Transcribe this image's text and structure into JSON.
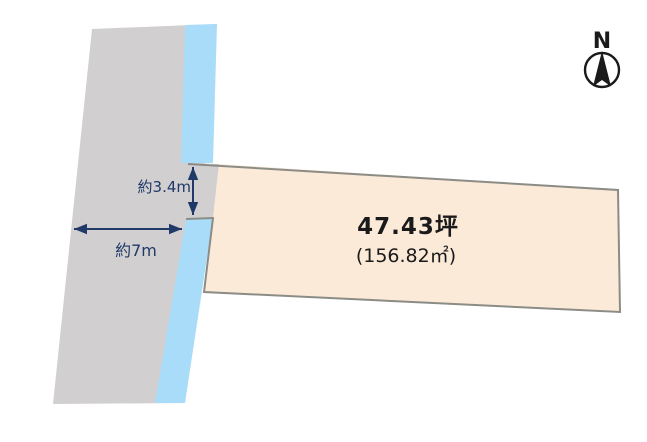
{
  "diagram": {
    "compass_label": "N",
    "parcel": {
      "area_tsubo": "47.43坪",
      "area_sqm_paren": "(156.82㎡)"
    },
    "dimensions": {
      "frontage_width": "約3.4m",
      "road_width": "約7m"
    }
  },
  "colors": {
    "background": "#ffffff",
    "road_fill": "#d1cfd0",
    "waterway_fill": "#a9dcf8",
    "parcel_fill": "#fcead9",
    "parcel_border": "#8c8c86",
    "dimension_accent": "#1f3a68",
    "label_text": "#1a1a1a",
    "compass": "#1a1a1a"
  }
}
